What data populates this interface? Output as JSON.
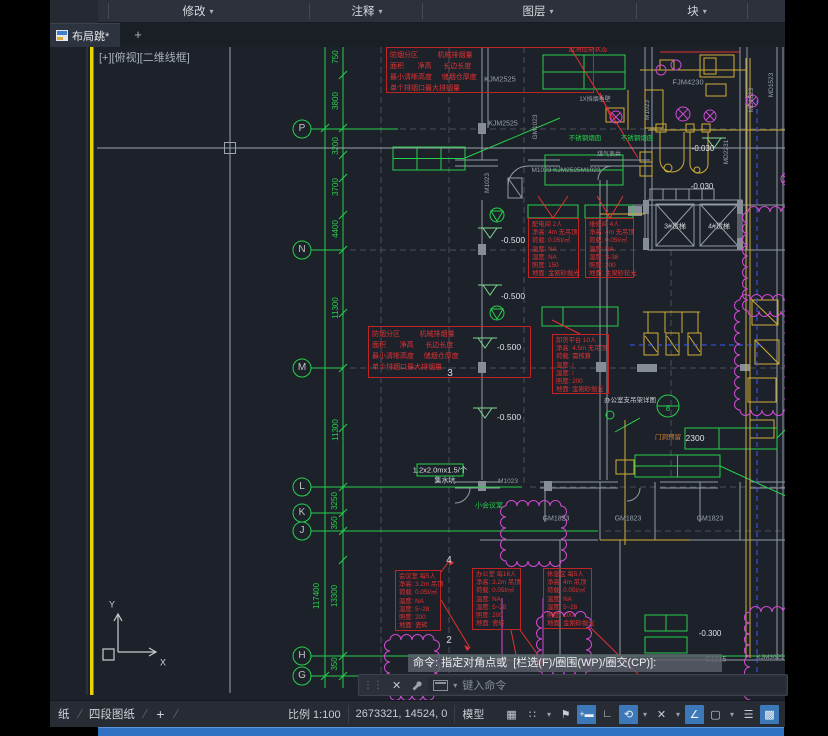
{
  "colors": {
    "cad_green": "#27d04c",
    "annotation_red": "#e23232",
    "duct_yellow": "#cfae35",
    "magenta": "#d24ad2",
    "accent_blue": "#3d79b8",
    "taskbar_blue": "#2f72c4",
    "gray_text": "#98a0a8",
    "white_text": "#dde2e6"
  },
  "icons": {
    "caret": "▾",
    "plus": "+",
    "close": "✕",
    "grip": "⋮⋮",
    "grid": "▦",
    "dots_grid": "∷",
    "snap_flag": "⚑",
    "ortho": "∟",
    "polar": "⟲",
    "isodraft": "✕",
    "otrack": "∠",
    "osnap": "▢",
    "lineweight": "☰",
    "checker": "▩",
    "dyninput": "+▬",
    "slash": "/"
  },
  "menu": {
    "items": [
      {
        "label": "修改"
      },
      {
        "label": "注释"
      },
      {
        "label": "图层"
      },
      {
        "label": "块"
      }
    ]
  },
  "tabs": {
    "active": "布局跳*",
    "new_tab": "+"
  },
  "viewport": {
    "label": "[+][俯视][二维线框]"
  },
  "command": {
    "history": "命令: 指定对角点或  [栏选(F)/圈围(WP)/圈交(CP)]:",
    "placeholder": "键入命令"
  },
  "statusbar": {
    "paper_tab": "纸",
    "layout_tab": "四段图纸",
    "plus": "+",
    "scale": "比例 1:100",
    "coords": "2673321, 14524, 0",
    "model": "模型"
  },
  "drawing": {
    "labels": [
      {
        "t": "P",
        "x": 302,
        "y": 129,
        "c": "#c0c6c0",
        "s": 10
      },
      {
        "t": "N",
        "x": 302,
        "y": 250,
        "c": "#c0c6c0",
        "s": 10
      },
      {
        "t": "M",
        "x": 302,
        "y": 368,
        "c": "#c0c6c0",
        "s": 10
      },
      {
        "t": "L",
        "x": 302,
        "y": 487,
        "c": "#c0c6c0",
        "s": 10
      },
      {
        "t": "K",
        "x": 302,
        "y": 513,
        "c": "#c0c6c0",
        "s": 10
      },
      {
        "t": "J",
        "x": 302,
        "y": 531,
        "c": "#c0c6c0",
        "s": 10
      },
      {
        "t": "H",
        "x": 302,
        "y": 656,
        "c": "#c0c6c0",
        "s": 10
      },
      {
        "t": "G",
        "x": 302,
        "y": 676,
        "c": "#c0c6c0",
        "s": 10
      },
      {
        "t": "3",
        "x": 450,
        "y": 374,
        "c": "#d2d7db",
        "s": 10
      },
      {
        "t": "4",
        "x": 449,
        "y": 561,
        "c": "#d2d7db",
        "s": 10
      },
      {
        "t": "2",
        "x": 449,
        "y": 641,
        "c": "#d2d7db",
        "s": 10
      },
      {
        "t": "750",
        "x": 336,
        "y": 57,
        "c": "#27d04c",
        "s": 8,
        "r": -90
      },
      {
        "t": "3800",
        "x": 336,
        "y": 101,
        "c": "#27d04c",
        "s": 8,
        "r": -90
      },
      {
        "t": "3200",
        "x": 336,
        "y": 146,
        "c": "#27d04c",
        "s": 8,
        "r": -90
      },
      {
        "t": "3700",
        "x": 336,
        "y": 187,
        "c": "#27d04c",
        "s": 8,
        "r": -90
      },
      {
        "t": "4400",
        "x": 336,
        "y": 229,
        "c": "#27d04c",
        "s": 8,
        "r": -90
      },
      {
        "t": "11300",
        "x": 336,
        "y": 308,
        "c": "#27d04c",
        "s": 8,
        "r": -90
      },
      {
        "t": "11300",
        "x": 336,
        "y": 430,
        "c": "#27d04c",
        "s": 8,
        "r": -90
      },
      {
        "t": "3250",
        "x": 335,
        "y": 501,
        "c": "#27d04c",
        "s": 8,
        "r": -90
      },
      {
        "t": "350",
        "x": 335,
        "y": 523,
        "c": "#27d04c",
        "s": 8,
        "r": -90
      },
      {
        "t": "117400",
        "x": 317,
        "y": 596,
        "c": "#27d04c",
        "s": 8,
        "r": -90
      },
      {
        "t": "13300",
        "x": 335,
        "y": 596,
        "c": "#27d04c",
        "s": 8,
        "r": -90
      },
      {
        "t": "350",
        "x": 335,
        "y": 664,
        "c": "#27d04c",
        "s": 8,
        "r": -90
      },
      {
        "t": "KJM2525",
        "x": 500,
        "y": 79,
        "c": "#98a0a8",
        "s": 7.5
      },
      {
        "t": "KJM2525",
        "x": 503,
        "y": 124,
        "c": "#98a0a8",
        "s": 7
      },
      {
        "t": "M1023",
        "x": 488,
        "y": 183,
        "c": "#98a0a8",
        "s": 6.5,
        "r": -90
      },
      {
        "t": "GM1023",
        "x": 536,
        "y": 127,
        "c": "#98a0a8",
        "s": 6.5,
        "r": -90
      },
      {
        "t": "M1023 KJM2525M1023",
        "x": 566,
        "y": 171,
        "c": "#98a0a8",
        "s": 6.5
      },
      {
        "t": "FJM4230",
        "x": 688,
        "y": 82,
        "c": "#98a0a8",
        "s": 7.5
      },
      {
        "t": "FJM4430",
        "x": 757,
        "y": 43,
        "c": "#98a0a8",
        "s": 6.5
      },
      {
        "t": "MD1823",
        "x": 752,
        "y": 100,
        "c": "#98a0a8",
        "s": 6.5,
        "r": -90
      },
      {
        "t": "MD1523",
        "x": 772,
        "y": 85,
        "c": "#98a0a8",
        "s": 6.5,
        "r": -90
      },
      {
        "t": "MD2231",
        "x": 727,
        "y": 152,
        "c": "#98a0a8",
        "s": 6.5,
        "r": -90
      },
      {
        "t": "M1023",
        "x": 648,
        "y": 110,
        "c": "#98a0a8",
        "s": 6.5,
        "r": -90
      },
      {
        "t": "-0.030",
        "x": 703,
        "y": 149,
        "c": "#dde2e6",
        "s": 8
      },
      {
        "t": "-0.030",
        "x": 702,
        "y": 187,
        "c": "#dde2e6",
        "s": 8
      },
      {
        "t": "-0.500",
        "x": 513,
        "y": 240,
        "c": "#dde2e6",
        "s": 8.5
      },
      {
        "t": "-0.500",
        "x": 513,
        "y": 296,
        "c": "#dde2e6",
        "s": 8.5
      },
      {
        "t": "-0.500",
        "x": 509,
        "y": 347,
        "c": "#dde2e6",
        "s": 8.5
      },
      {
        "t": "-0.500",
        "x": 509,
        "y": 417,
        "c": "#dde2e6",
        "s": 8.5
      },
      {
        "t": "-0.300",
        "x": 710,
        "y": 634,
        "c": "#dde2e6",
        "s": 8
      },
      {
        "t": "不锈钢烟囱",
        "x": 585,
        "y": 139,
        "c": "#27d04c",
        "s": 6.5
      },
      {
        "t": "不锈钢烟囱",
        "x": 637,
        "y": 139,
        "c": "#27d04c",
        "s": 6.5
      },
      {
        "t": "煤气表井",
        "x": 609,
        "y": 155,
        "c": "#98a0a8",
        "s": 6
      },
      {
        "t": "1X挡烟垂壁",
        "x": 595,
        "y": 100,
        "c": "#98a0a8",
        "s": 6
      },
      {
        "t": "办公室支吊架详图",
        "x": 630,
        "y": 401,
        "c": "#ccd1d6",
        "s": 6.5
      },
      {
        "t": "8",
        "x": 668,
        "y": 409,
        "c": "#27d04c",
        "s": 8
      },
      {
        "t": "门洞预留",
        "x": 668,
        "y": 438,
        "c": "#d08030",
        "s": 6.5
      },
      {
        "t": "2300",
        "x": 695,
        "y": 438,
        "c": "#dde2e6",
        "s": 8.5
      },
      {
        "t": "1.2x2.0mx1.5/个",
        "x": 440,
        "y": 470,
        "c": "#dde2e6",
        "s": 7.5
      },
      {
        "t": "集水坑",
        "x": 445,
        "y": 481,
        "c": "#dde2e6",
        "s": 7
      },
      {
        "t": "小会议室",
        "x": 489,
        "y": 506,
        "c": "#27d04c",
        "s": 7
      },
      {
        "t": "M1023",
        "x": 508,
        "y": 482,
        "c": "#98a0a8",
        "s": 6.5
      },
      {
        "t": "GM1823",
        "x": 556,
        "y": 519,
        "c": "#98a0a8",
        "s": 7
      },
      {
        "t": "GM1823",
        "x": 628,
        "y": 519,
        "c": "#98a0a8",
        "s": 7
      },
      {
        "t": "GM1823",
        "x": 710,
        "y": 519,
        "c": "#98a0a8",
        "s": 7
      },
      {
        "t": "C1215",
        "x": 716,
        "y": 660,
        "c": "#98a0a8",
        "s": 7
      },
      {
        "t": "KJM3025",
        "x": 770,
        "y": 658,
        "c": "#98a0a8",
        "s": 6.5
      },
      {
        "t": "3#货梯",
        "x": 675,
        "y": 227,
        "c": "#d2d7db",
        "s": 7
      },
      {
        "t": "4#货梯",
        "x": 719,
        "y": 227,
        "c": "#d2d7db",
        "s": 7
      },
      {
        "t": "监测控制状态",
        "x": 588,
        "y": 50,
        "c": "#e23232",
        "s": 6.5
      },
      {
        "t": "高压充电间",
        "x": 690,
        "y": 45,
        "c": "#e23232",
        "s": 6.5
      },
      {
        "t": "Y",
        "x": 112,
        "y": 605,
        "c": "#cdd2d7",
        "s": 9
      },
      {
        "t": "X",
        "x": 163,
        "y": 663,
        "c": "#cdd2d7",
        "s": 9
      }
    ],
    "annotation_boxes": [
      {
        "x": 386,
        "y": 47,
        "w": 208,
        "h": 46,
        "big": true,
        "lines": [
          "防烟分区          机械排烟量",
          "面积       净高      长边长度",
          "最小清晰高度     储烟仓厚度",
          "单个排烟口最大排烟量"
        ]
      },
      {
        "x": 368,
        "y": 326,
        "w": 163,
        "h": 52,
        "big": true,
        "lines": [
          "防烟分区          机械排烟量",
          "面积       净高      长边长度",
          "最小清晰高度     储烟仓厚度",
          "单个排烟口最大排烟量"
        ]
      },
      {
        "x": 528,
        "y": 218,
        "w": 51,
        "h": 60,
        "lines": [
          "配电间 2人",
          "净高: 4m 无吊顶",
          "荷载: 0.05t/㎡",
          "温度: NA",
          "湿度: NA",
          "照度: 150",
          "地面: 金刚砂抛光"
        ]
      },
      {
        "x": 585,
        "y": 218,
        "w": 49,
        "h": 60,
        "lines": [
          "维修间 4人",
          "净高: 4m 无吊顶",
          "荷载: 0.05t/㎡",
          "温度: NA",
          "湿度: S-38",
          "照度: 200",
          "地面: 主梁砂轮光"
        ]
      },
      {
        "x": 552,
        "y": 334,
        "w": 57,
        "h": 60,
        "lines": [
          "卸货平台 10人",
          "净高: 4.5m 无吊顶",
          "荷载: 需核算",
          "温度: /",
          "湿度: /",
          "照度: 200",
          "地面: 金刚砂抛光"
        ]
      },
      {
        "x": 395,
        "y": 570,
        "w": 46,
        "h": 61,
        "lines": [
          "会议室 每5人",
          "净高: 3.2m 吊顶",
          "荷载: 0.05t/㎡",
          "温度: NA",
          "湿度: 5~28",
          "照度: 200",
          "地面: 瓷砖"
        ]
      },
      {
        "x": 472,
        "y": 568,
        "w": 49,
        "h": 62,
        "lines": [
          "办公室 每16人",
          "净高: 3.2m 吊顶",
          "荷载: 0.05t/㎡",
          "温度: NA",
          "湿度: 5~28",
          "照度: 200",
          "地面: 瓷砖"
        ]
      },
      {
        "x": 543,
        "y": 568,
        "w": 49,
        "h": 61,
        "lines": [
          "休息区 每5人",
          "净高: 4m 吊顶",
          "荷载: 0.05t/㎡",
          "温度: NA",
          "湿度: 5~28",
          "照度: 200",
          "地面: 金刚砂抛光"
        ]
      }
    ]
  }
}
